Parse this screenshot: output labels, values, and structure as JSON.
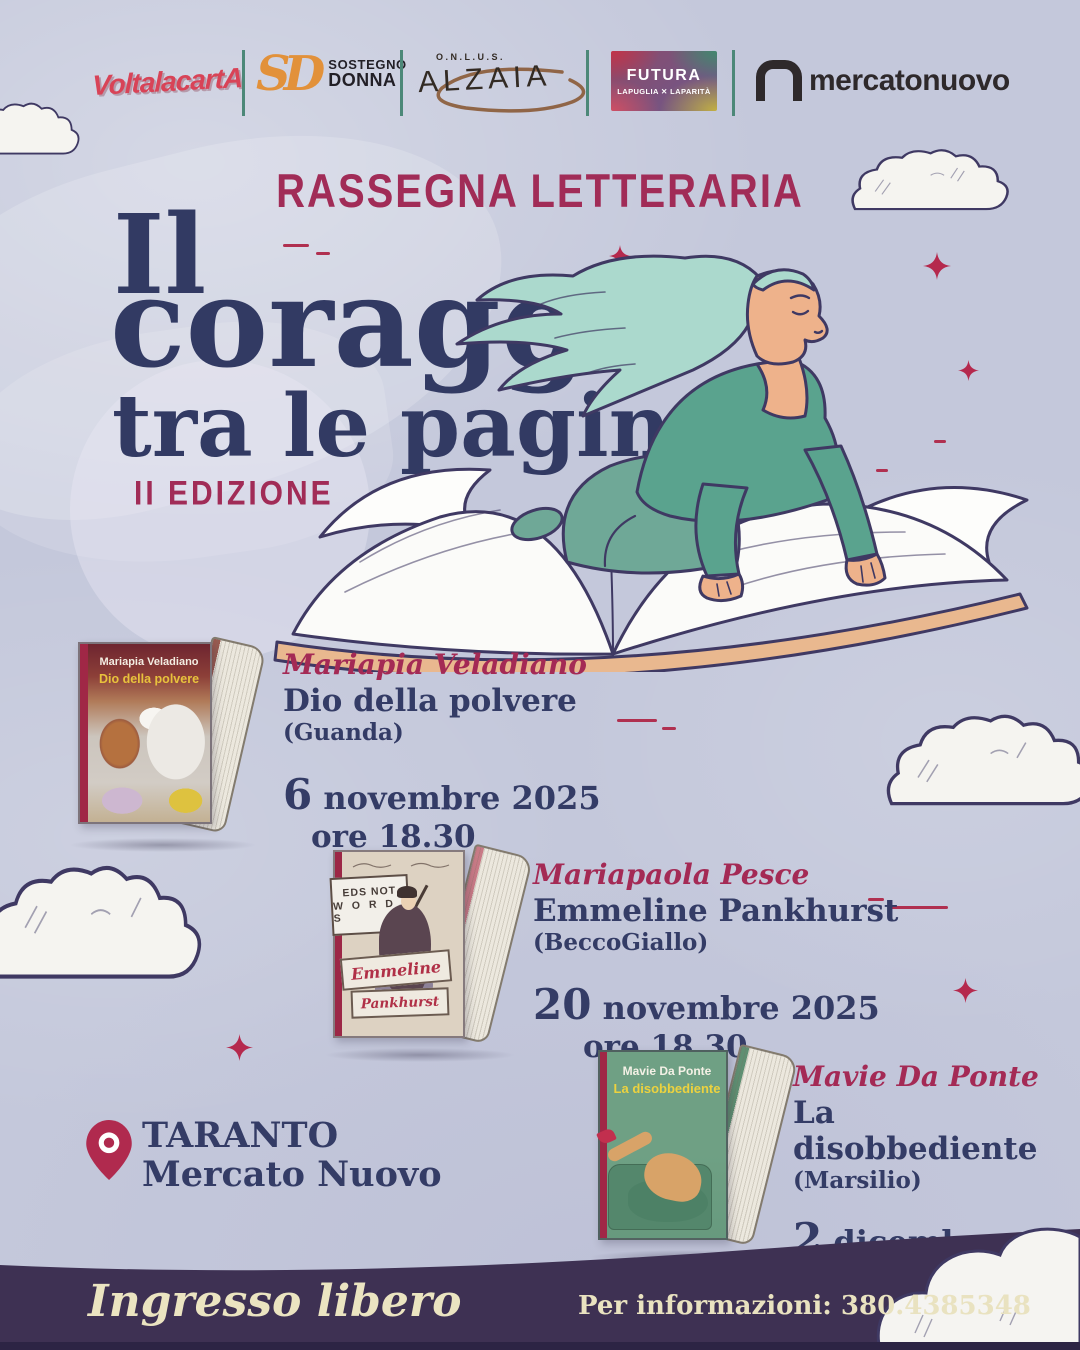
{
  "logos": {
    "volta": {
      "text": "VoltalacartA"
    },
    "sostegno": {
      "monogram": "SD",
      "line1": "SOSTEGNO",
      "line2": "DONNA"
    },
    "alzaia": {
      "sub": "O.N.L.U.S.",
      "text": "ALZAIA"
    },
    "futura": {
      "text": "FUTURA",
      "sub": "LAPUGLIA ✕ LAPARITÀ"
    },
    "mercato": {
      "text": "mercatonuovo"
    }
  },
  "title_block": {
    "eyebrow": "RASSEGNA LETTERARIA",
    "line1": "Il",
    "line2": "coraggio",
    "line3": "tra le pagine",
    "edition": "II EDIZIONE"
  },
  "events": [
    {
      "author": "Mariapia Veladiano",
      "book": "Dio della polvere",
      "publisher": "(Guanda)",
      "date_day": "6",
      "date_rest": "novembre 2025",
      "time": "ore 18.30",
      "cover": {
        "author": "Mariapia Veladiano",
        "title": "Dio della polvere"
      }
    },
    {
      "author": "Mariapaola Pesce",
      "book": "Emmeline Pankhurst",
      "publisher": "(BeccoGiallo)",
      "date_day": "20",
      "date_rest": "novembre 2025",
      "time": "ore 18.30",
      "cover": {
        "flag_line1": "EDS NOT",
        "flag_line2": "W O R D S",
        "ribbon_line1": "Emmeline",
        "ribbon_line2": "Pankhurst"
      }
    },
    {
      "author": "Mavie Da Ponte",
      "book": "La disobbediente",
      "publisher": "(Marsilio)",
      "date_day": "2",
      "date_rest": "dicembre 2025",
      "time": "ore 18.30",
      "cover": {
        "author": "Mavie Da Ponte",
        "title": "La disobbediente"
      }
    }
  ],
  "location": {
    "city": "TARANTO",
    "venue": "Mercato Nuovo"
  },
  "footer": {
    "admission": "Ingresso libero",
    "info": "Per informazioni: 380.4385348"
  },
  "colors": {
    "background": "#c4c8db",
    "navy": "#343c66",
    "crimson": "#a42a55",
    "sparkle_red": "#b5294d",
    "teal_sweater": "#5aa38e",
    "hair_mint": "#abd9cd",
    "footer_purple": "#3e3153",
    "cream": "#ebe4c1",
    "logo_orange": "#e2913a",
    "logo_red": "#d84357",
    "separator_teal": "#4c8878"
  }
}
